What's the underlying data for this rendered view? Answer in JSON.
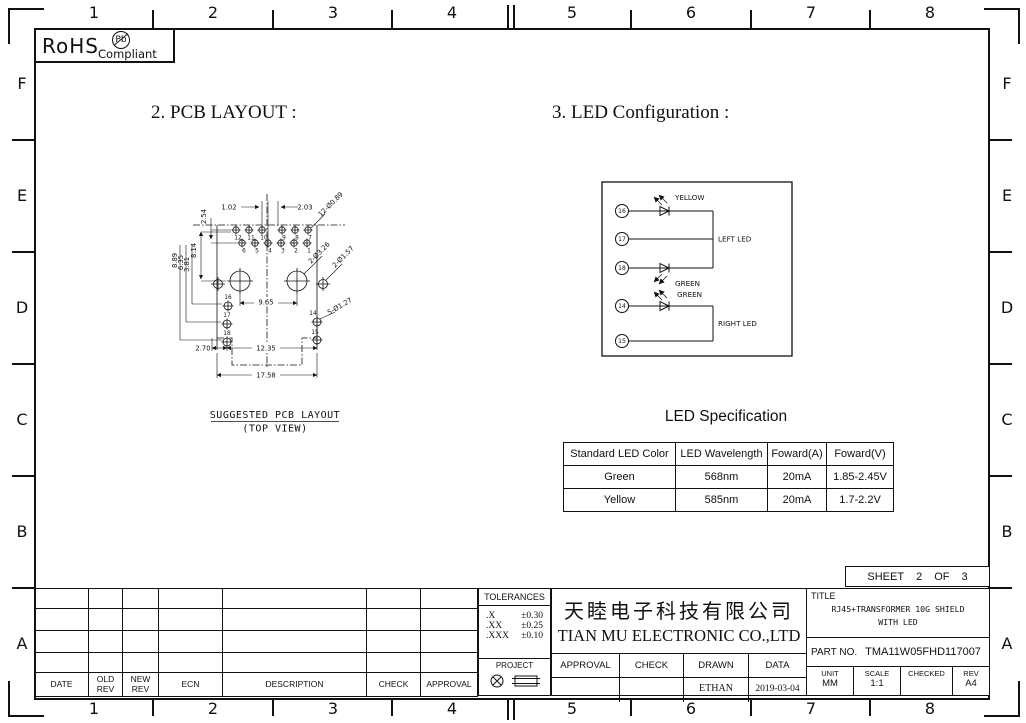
{
  "grid": {
    "cols": [
      "1",
      "2",
      "3",
      "4",
      "5",
      "6",
      "7",
      "8"
    ],
    "rows": [
      "F",
      "E",
      "D",
      "C",
      "B",
      "A"
    ]
  },
  "rohs": {
    "name": "RoHS",
    "pb": "Pb",
    "compliant": "Compliant"
  },
  "headings": {
    "pcb": "2. PCB LAYOUT :",
    "led": "3. LED Configuration :"
  },
  "pcb": {
    "pins_row1": [
      "12",
      "11",
      "10",
      "9",
      "8",
      "7"
    ],
    "pins_row2": [
      "6",
      "5",
      "4",
      "3",
      "2",
      "1"
    ],
    "pins_left": [
      "16",
      "17",
      "18"
    ],
    "pins_right": [
      "14",
      "15"
    ],
    "dims": {
      "pitch_v": "2.54",
      "offset": "1.02",
      "pitch": "2.03",
      "holes_small": "12-Ø0.89",
      "d814": "8.14",
      "d889": "8.89",
      "d635": "6.35",
      "d381": "3.81",
      "holes_big": "2-Ø3.26",
      "holes_post": "2-Ø1.57",
      "d965": "9.65",
      "holes_led": "5-Ø1.27",
      "d270": "2.70",
      "d1235": "12.35",
      "d1758": "17.58"
    },
    "caption1": "SUGGESTED PCB LAYOUT",
    "caption2": "(TOP VIEW)"
  },
  "led_config": {
    "pins_left": [
      "16",
      "17",
      "18"
    ],
    "pins_right": [
      "14",
      "15"
    ],
    "yellow": "YELLOW",
    "green_left": "GREEN",
    "green_right": "GREEN",
    "left_label": "LEFT LED",
    "right_label": "RIGHT LED"
  },
  "led_spec": {
    "title": "LED Specification",
    "headers": [
      "Standard LED Color",
      "LED Wavelength",
      "Foward(A)",
      "Foward(V)"
    ],
    "rows": [
      [
        "Green",
        "568nm",
        "20mA",
        "1.85-2.45V"
      ],
      [
        "Yellow",
        "585nm",
        "20mA",
        "1.7-2.2V"
      ]
    ]
  },
  "sheet": {
    "label": "SHEET",
    "num": "2",
    "of": "OF",
    "total": "3"
  },
  "revisions": {
    "headers": [
      "DATE",
      "OLD REV",
      "NEW REV",
      "ECN",
      "DESCRIPTION",
      "CHECK",
      "APPROVAL"
    ]
  },
  "tolerances": {
    "title": "TOLERANCES",
    "rows": [
      {
        "label": ".X",
        "value": "±0.30"
      },
      {
        "label": ".XX",
        "value": "±0.25"
      },
      {
        "label": ".XXX",
        "value": "±0.10"
      }
    ],
    "project": "PROJECT"
  },
  "company": {
    "cn": "天睦电子科技有限公司",
    "en": "TIAN MU ELECTRONIC CO.,LTD",
    "sign_headers": [
      "APPROVAL",
      "CHECK",
      "DRAWN",
      "DATA"
    ],
    "drawn_by": "ETHAN",
    "date": "2019-03-04"
  },
  "title_block": {
    "title_label": "TITLE",
    "line1": "RJ45+TRANSFORMER 10G SHIELD",
    "line2": "WITH LED",
    "part_label": "PART NO.",
    "part_no": "TMA11W05FHD117007",
    "unit_label": "UNIT",
    "unit": "MM",
    "scale_label": "SCALE",
    "scale": "1:1",
    "checked_label": "CHECKED",
    "checked": "",
    "rev_label": "REV",
    "rev": "A4"
  }
}
